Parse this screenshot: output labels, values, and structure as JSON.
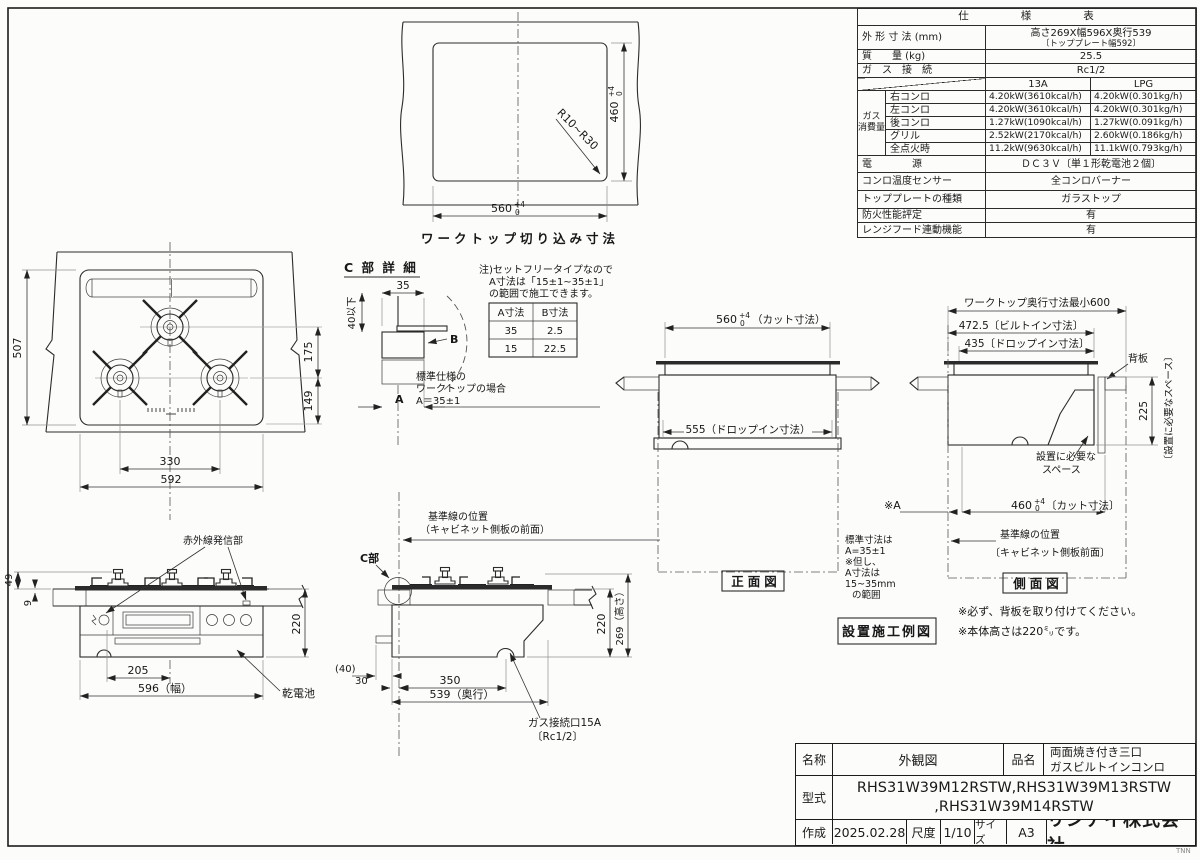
{
  "sheet": {
    "watermark": "TNN"
  },
  "spec": {
    "title": "仕　　　　様　　　　表",
    "rows": [
      {
        "label": "外 形 寸 法 (mm)",
        "value": "高さ269X幅596X奥行539",
        "value_sub": "〔トッププレート幅592〕"
      },
      {
        "label": "質　　量 (kg)",
        "value": "25.5"
      },
      {
        "label": "ガ　ス　接　続",
        "value": "Rc1/2"
      }
    ],
    "gas": {
      "col_a": "13A",
      "col_b": "LPG",
      "group1": "ガス",
      "group2": "消費量",
      "rows": [
        {
          "label": "右コンロ",
          "a": "4.20kW(3610kcal/h)",
          "b": "4.20kW(0.301kg/h)"
        },
        {
          "label": "左コンロ",
          "a": "4.20kW(3610kcal/h)",
          "b": "4.20kW(0.301kg/h)"
        },
        {
          "label": "後コンロ",
          "a": "1.27kW(1090kcal/h)",
          "b": "1.27kW(0.091kg/h)"
        },
        {
          "label": "グリル",
          "a": "2.52kW(2170kcal/h)",
          "b": "2.60kW(0.186kg/h)"
        },
        {
          "label": "全点火時",
          "a": "11.2kW(9630kcal/h)",
          "b": "11.1kW(0.793kg/h)"
        }
      ]
    },
    "bottom": [
      {
        "label": "電　　　　源",
        "value": "ＤＣ３Ｖ〔単１形乾電池２個〕"
      },
      {
        "label": "コンロ温度センサー",
        "value": "全コンロバーナー"
      },
      {
        "label": "トッププレートの種類",
        "value": "ガラストップ"
      },
      {
        "label": "防火性能評定",
        "value": "有"
      },
      {
        "label": "レンジフード連動機能",
        "value": "有"
      }
    ]
  },
  "cutout": {
    "caption": "ワークトップ切り込み寸法",
    "dim_w": "560",
    "dim_h": "460",
    "tol_p": "+4",
    "tol_z": "0",
    "radius": "R10~R30"
  },
  "plan": {
    "d507": "507",
    "d175": "175",
    "d149": "149",
    "d330": "330",
    "d592": "592"
  },
  "detail": {
    "title": "C 部 詳 細",
    "d35": "35",
    "d40": "40以下",
    "a": "A",
    "b": "B",
    "note1": "注)セットフリータイプなので",
    "note2": "A寸法は「15±1~35±1」",
    "note3": "の範囲で施工できます。",
    "th_a": "A寸法",
    "th_b": "B寸法",
    "r1a": "35",
    "r1b": "2.5",
    "r2a": "15",
    "r2b": "22.5",
    "std1": "標準仕様の",
    "std2": "ワークトップの場合",
    "std3": "A＝35±1"
  },
  "front": {
    "d560": "560",
    "tol_p": "+4",
    "tol_z": "0",
    "cut": "（カット寸法）",
    "drop": "555（ドロップイン寸法）",
    "caption": "正面図"
  },
  "side": {
    "d600": "ワークトップ奥行寸法最小600",
    "d472": "472.5〔ビルトイン寸法〕",
    "d435": "435〔ドロップイン寸法〕",
    "seban": "背板",
    "d225": "225",
    "vspace": "〔設置に必要なスペース〕",
    "sp1": "設置に必要な",
    "sp2": "スペース",
    "refa": "※A",
    "d460": "460",
    "tol_p": "+4",
    "tol_z": "0",
    "cut": "〔カット寸法〕",
    "base1": "基準線の位置",
    "base2": "〔キャビネット側板前面〕",
    "caption": "側面図",
    "n1": "標準寸法は",
    "n2": "A=35±1",
    "n3": "※但し、",
    "n4": "A寸法は",
    "n5": "15~35mm",
    "n6": "の範囲"
  },
  "efront": {
    "ir": "赤外線発信部",
    "d49": "49",
    "d9": "9",
    "d220": "220",
    "d205": "205",
    "d596": "596（幅）",
    "battery": "乾電池"
  },
  "eside": {
    "base1": "基準線の位置",
    "base2": "（キャビネット側板の前面）",
    "c": "C部",
    "d220": "220",
    "d269": "269（高さ）",
    "d40": "(40)",
    "d30": "30",
    "d350": "350",
    "d539": "539（奥行）",
    "gas1": "ガス接続口15A",
    "gas2": "〔Rc1/2〕"
  },
  "install": {
    "label": "設置施工例図"
  },
  "notes": {
    "n1": "※必ず、背板を取り付けてください。",
    "n2": "※本体高さは220㍉です。"
  },
  "tb": {
    "name_l": "名称",
    "name_v": "外観図",
    "prod_l": "品名",
    "prod_v1": "両面焼き付き三口",
    "prod_v2": "ガスビルトインコンロ",
    "model_l": "型式",
    "model_v1": "RHS31W39M12RSTW,RHS31W39M13RSTW",
    "model_v2": ",RHS31W39M14RSTW",
    "date_l": "作成",
    "date_v": "2025.02.28",
    "scale_l": "尺度",
    "scale_v": "1/10",
    "size_l": "サイズ",
    "size_v": "A3",
    "company": "リンナイ株式会社"
  }
}
